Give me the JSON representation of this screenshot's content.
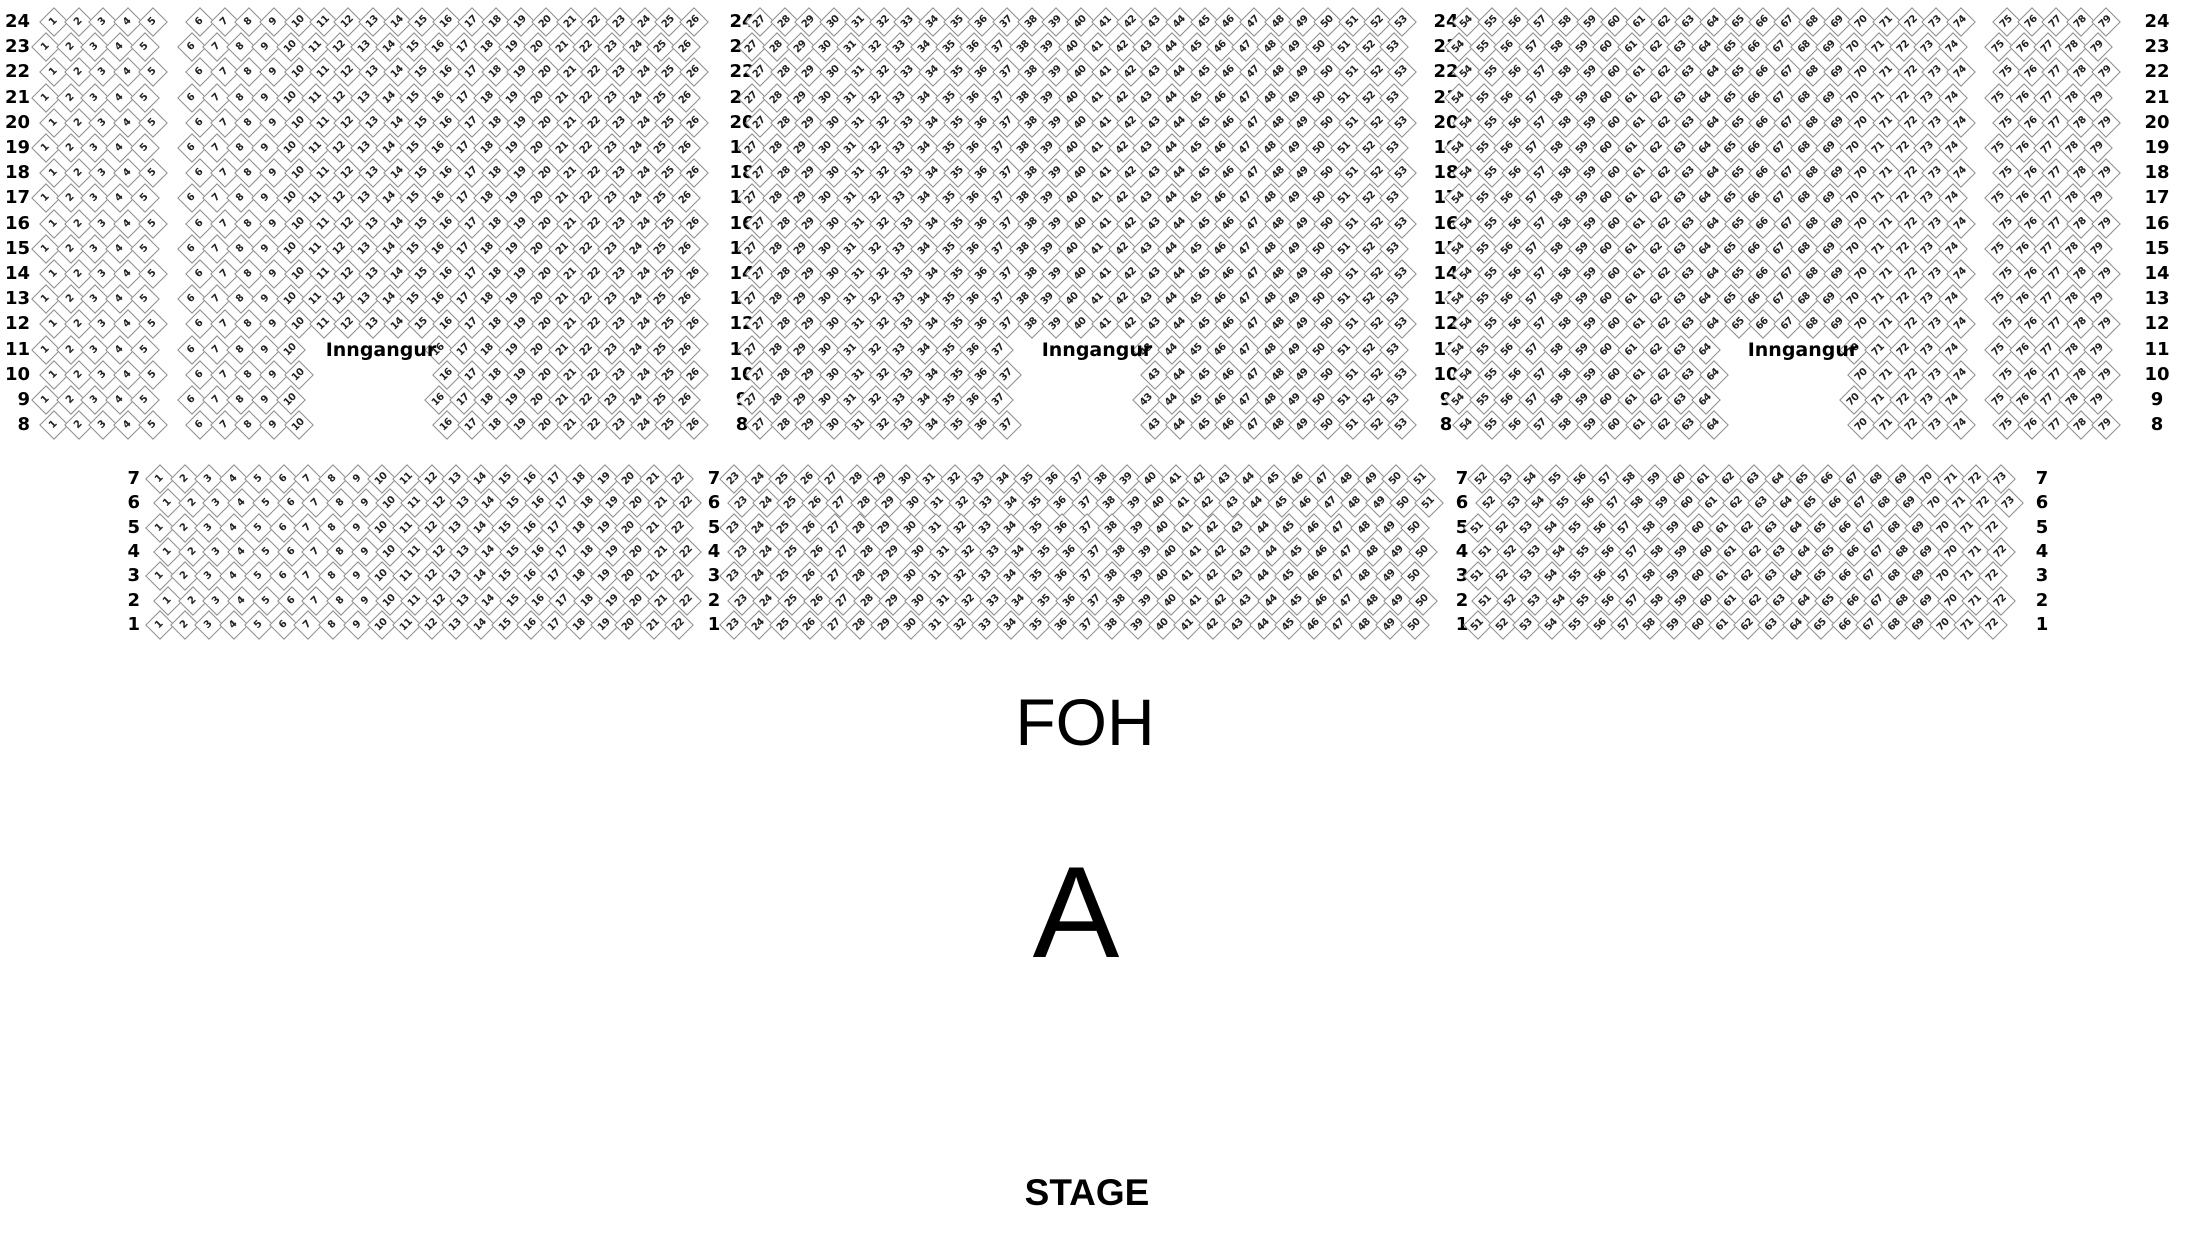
{
  "labels": {
    "foh": "FOH",
    "section": "A",
    "stage": "STAGE",
    "entrance": "Inngangur"
  },
  "colors": {
    "background": "#ffffff",
    "seat_fill": "#ffffff",
    "seat_border": "#8d8d8d",
    "seat_number_text": "#222222",
    "label_text": "#000000"
  },
  "seatmap": {
    "upper_section": {
      "rows": {
        "from": 24,
        "to": 8
      },
      "geometry": {
        "y_row_start": 22,
        "row_pitch": 25.2,
        "even_row_x_offset": 8
      },
      "row_label_columns": [
        {
          "x": 30,
          "align": "right"
        },
        {
          "x": 742,
          "align": "center"
        },
        {
          "x": 1446,
          "align": "center"
        },
        {
          "x": 2157,
          "align": "center"
        }
      ],
      "blocks": [
        {
          "id": "upper-block-1",
          "groups": [
            {
              "row_from": 24,
              "row_to": 8,
              "ranges": [
                {
                  "first": 1,
                  "last": 5,
                  "x_first": 46,
                  "x_last": 144.8
                }
              ]
            }
          ]
        },
        {
          "id": "upper-block-2",
          "groups": [
            {
              "row_from": 24,
              "row_to": 12,
              "ranges": [
                {
                  "first": 6,
                  "last": 26,
                  "x_first": 192,
                  "x_last": 686
                }
              ]
            },
            {
              "row_from": 11,
              "row_to": 8,
              "ranges": [
                {
                  "first": 6,
                  "last": 10,
                  "x_first": 192,
                  "x_last": 290.8
                },
                {
                  "first": 16,
                  "last": 26,
                  "x_first": 439,
                  "x_last": 686
                }
              ]
            }
          ],
          "entrance": {
            "x": 381,
            "y": 350
          }
        },
        {
          "id": "upper-block-3",
          "groups": [
            {
              "row_from": 24,
              "row_to": 12,
              "ranges": [
                {
                  "first": 27,
                  "last": 53,
                  "x_first": 752,
                  "x_last": 1394.2
                }
              ]
            },
            {
              "row_from": 11,
              "row_to": 8,
              "ranges": [
                {
                  "first": 27,
                  "last": 37,
                  "x_first": 752,
                  "x_last": 999
                },
                {
                  "first": 43,
                  "last": 53,
                  "x_first": 1147.2,
                  "x_last": 1394.2
                }
              ]
            }
          ],
          "entrance": {
            "x": 1097,
            "y": 350
          }
        },
        {
          "id": "upper-block-4",
          "groups": [
            {
              "row_from": 24,
              "row_to": 12,
              "ranges": [
                {
                  "first": 54,
                  "last": 74,
                  "x_first": 1459,
                  "x_last": 1953
                }
              ]
            },
            {
              "row_from": 11,
              "row_to": 8,
              "ranges": [
                {
                  "first": 54,
                  "last": 64,
                  "x_first": 1459,
                  "x_last": 1706
                },
                {
                  "first": 70,
                  "last": 74,
                  "x_first": 1854.2,
                  "x_last": 1953
                }
              ]
            }
          ],
          "entrance": {
            "x": 1803,
            "y": 350
          }
        },
        {
          "id": "upper-block-5",
          "groups": [
            {
              "row_from": 24,
              "row_to": 8,
              "ranges": [
                {
                  "first": 75,
                  "last": 79,
                  "x_first": 1999,
                  "x_last": 2097.8
                }
              ]
            }
          ]
        }
      ]
    },
    "lower_section": {
      "rows": {
        "from": 7,
        "to": 1
      },
      "geometry": {
        "y_row_start": 479,
        "row_pitch": 24.3,
        "even_row_x_offset": 8
      },
      "row_label_columns": [
        {
          "x": 140,
          "align": "right"
        },
        {
          "x": 714,
          "align": "center"
        },
        {
          "x": 1462,
          "align": "center"
        },
        {
          "x": 2042,
          "align": "center"
        }
      ],
      "blocks": [
        {
          "id": "lower-block-1",
          "groups": [
            {
              "row_from": 7,
              "row_to": 1,
              "ranges": [
                {
                  "first": 1,
                  "last": 22,
                  "x_first": 160,
                  "x_last": 678.7
                }
              ]
            }
          ]
        },
        {
          "id": "lower-block-2",
          "groups": [
            {
              "row_from": 7,
              "row_to": 6,
              "ranges": [
                {
                  "first": 23,
                  "last": 51,
                  "x_first": 734,
                  "x_last": 1421
                }
              ]
            },
            {
              "row_from": 5,
              "row_to": 1,
              "ranges": [
                {
                  "first": 23,
                  "last": 50,
                  "x_first": 734,
                  "x_last": 1415
                }
              ]
            }
          ]
        },
        {
          "id": "lower-block-3",
          "groups": [
            {
              "row_from": 7,
              "row_to": 6,
              "ranges": [
                {
                  "first": 52,
                  "last": 73,
                  "x_first": 1482,
                  "x_last": 2001
                }
              ]
            },
            {
              "row_from": 5,
              "row_to": 1,
              "ranges": [
                {
                  "first": 51,
                  "last": 72,
                  "x_first": 1478,
                  "x_last": 1993
                }
              ]
            }
          ]
        }
      ]
    }
  }
}
